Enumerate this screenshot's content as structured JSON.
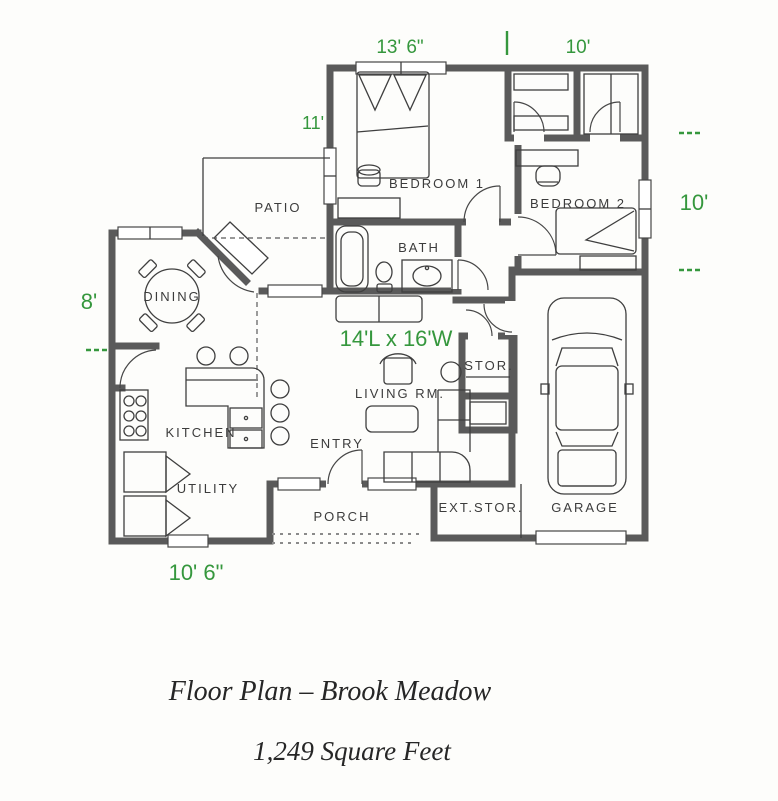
{
  "plan": {
    "dims": {
      "top_left": "13' 6\"",
      "top_right": "10'",
      "upper_left": "11'",
      "right": "10'",
      "left": "8'",
      "bottom": "10' 6\"",
      "living_size": "14'L x 16'W"
    },
    "rooms": {
      "bedroom1": "BEDROOM 1",
      "bedroom2": "BEDROOM 2",
      "bath": "BATH",
      "patio": "PATIO",
      "dining": "DINING",
      "kitchen": "KITCHEN",
      "utility": "UTILITY",
      "living": "LIVING RM.",
      "entry": "ENTRY",
      "porch": "PORCH",
      "ext_storage": "EXT.STOR.",
      "garage": "GARAGE",
      "storage": "STOR."
    },
    "colors": {
      "dimension_green": "#35973d",
      "wall_gray": "#5a5a5a",
      "line_dark": "#3f3f3f"
    }
  },
  "caption": {
    "title": "Floor Plan – Brook Meadow",
    "subtitle": "1,249 Square Feet"
  }
}
